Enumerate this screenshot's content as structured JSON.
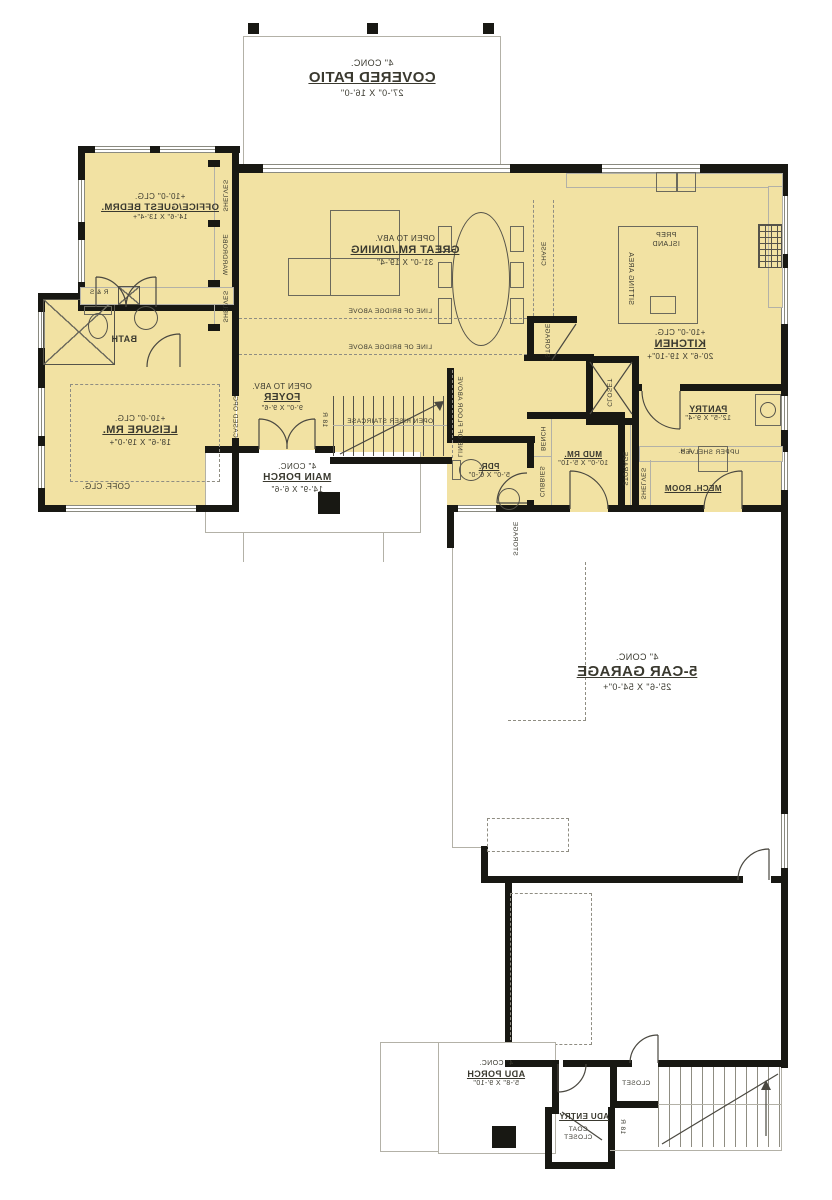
{
  "colors": {
    "room_fill": "#F2E2A3",
    "wall": "#181813",
    "accent_gray": "#8f8d82",
    "text": "#3a392f"
  },
  "rooms": {
    "covered_patio": {
      "conc": "4\" CONC.",
      "name": "COVERED PATIO",
      "dims": "27'-0\" X 16'-0\""
    },
    "office": {
      "clg": "+10'-0\" CLG.",
      "name": "OFFICE/GUEST BEDRM.",
      "dims": "14'-6\" X 13'-4\"+"
    },
    "great_room": {
      "open": "OPEN TO ABV.",
      "name": "GREAT RM./DINING",
      "dims": "31'-0\" X 19'-4\""
    },
    "kitchen": {
      "clg": "+10'-0\" CLG.",
      "name": "KITCHEN",
      "dims": "20'-6\" X 19'-10\"+"
    },
    "pantry": {
      "name": "PANTRY",
      "dims": "12'-5\" X 9'-4\""
    },
    "mud_room": {
      "name": "MUD RM.",
      "dims": "10'-0\" X 5'-10\""
    },
    "mech_room": {
      "name": "MECH. ROOM"
    },
    "powder": {
      "name": "PDR.",
      "dims": "5'-0\" X 6'-0\""
    },
    "foyer": {
      "open": "OPEN TO ABV.",
      "name": "FOYER",
      "dims": "9'-0\" X 9'-6\""
    },
    "leisure": {
      "clg": "+10'-0\" CLG.",
      "name": "LEISURE RM.",
      "dims": "18'-6\" X 19'-0\"+",
      "coff": "COFF. CLG."
    },
    "bath": {
      "name": "BATH"
    },
    "main_porch": {
      "conc": "4\" CONC.",
      "name": "MAIN PORCH",
      "dims": "14'-9\" X 6'-6\""
    },
    "garage": {
      "conc": "4\" CONC.",
      "name": "5-CAR GARAGE",
      "dims": "25'-6\" X 54'-0\"+"
    },
    "adu_porch": {
      "conc": "4\" CONC.",
      "name": "ADU PORCH",
      "dims": "5'-8\" X 9'-10\""
    },
    "adu_entry": {
      "name": "ADU ENTRY"
    },
    "coat_closet": {
      "line1": "COAT",
      "line2": "CLOSET"
    },
    "closet_lower": {
      "name": "CLOSET"
    }
  },
  "annotations": {
    "prep_island_1": "PREP",
    "prep_island_2": "ISLAND",
    "sitting_area": "SITTING AREA",
    "upper_shelves": "UPPER SHELVES",
    "closet_v": "CLOSET",
    "bench": "BENCH",
    "cubbies": "CUBBIES",
    "storage_mud": "STORAGE",
    "shelves_mech": "SHELVES",
    "ah": "A.H.",
    "rs": "R & S",
    "cased_opg": "CASED OPG.",
    "open_riser": "OPEN RISER STAIRCASE",
    "riser_count": "18 R",
    "riser_count_lower": "18 R",
    "bridge_above": "LINE OF BRIDGE ABOVE",
    "floor_above": "LINE OF FLOOR ABOVE",
    "chase": "CHASE",
    "storage_chase": "STORAGE",
    "storage_garage": "STORAGE",
    "shelves_top": "SHELVES",
    "wardrobe": "WARDROBE",
    "shelves_bottom": "SHELVES"
  }
}
